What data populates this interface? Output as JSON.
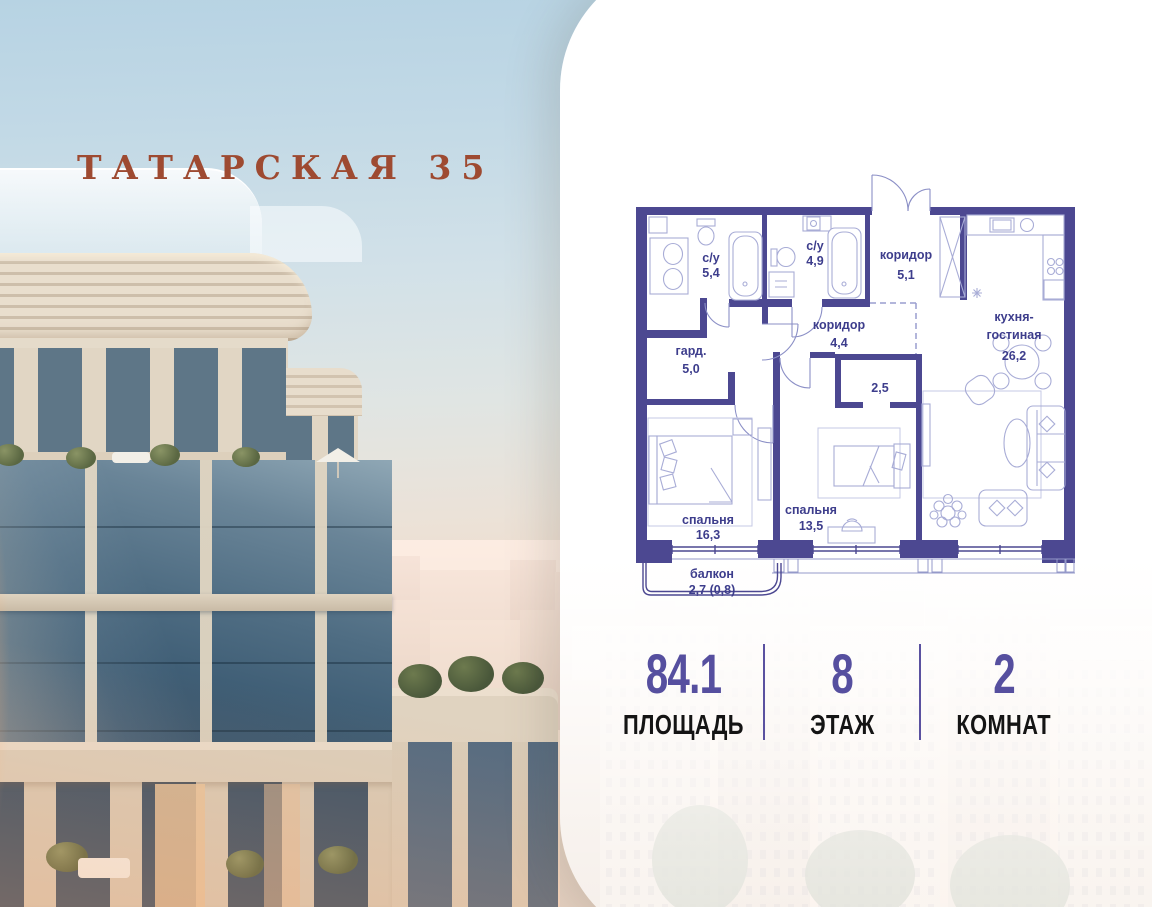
{
  "header": {
    "title": "ТАТАРСКАЯ 35"
  },
  "plan": {
    "rooms": [
      {
        "id": "bathroom-1",
        "label": "с/у",
        "area": "5,4"
      },
      {
        "id": "bathroom-2",
        "label": "с/у",
        "area": "4,9"
      },
      {
        "id": "entry-hall",
        "label": "коридор",
        "area": "5,1"
      },
      {
        "id": "hallway",
        "label": "коридор",
        "area": "4,4"
      },
      {
        "id": "kitchen-living",
        "label_line1": "кухня-",
        "label_line2": "гостиная",
        "area": "26,2"
      },
      {
        "id": "wardrobe",
        "label": "гард.",
        "area": "5,0"
      },
      {
        "id": "closet",
        "area": "2,5"
      },
      {
        "id": "bedroom-1",
        "label": "спальня",
        "area": "16,3"
      },
      {
        "id": "bedroom-2",
        "label": "спальня",
        "area": "13,5"
      },
      {
        "id": "balcony",
        "label": "балкон",
        "area": "2,7 (0,8)"
      }
    ]
  },
  "stats": {
    "items": [
      {
        "value": "84.1",
        "label": "ПЛОЩАДЬ"
      },
      {
        "value": "8",
        "label": "ЭТАЖ"
      },
      {
        "value": "2",
        "label": "КОМНАТ"
      }
    ]
  },
  "colors": {
    "wall": "#4c4891",
    "plan_label": "#3d3d8c",
    "title": "#9e4a31",
    "stat_value": "#564f9f",
    "stat_label": "#141414"
  }
}
